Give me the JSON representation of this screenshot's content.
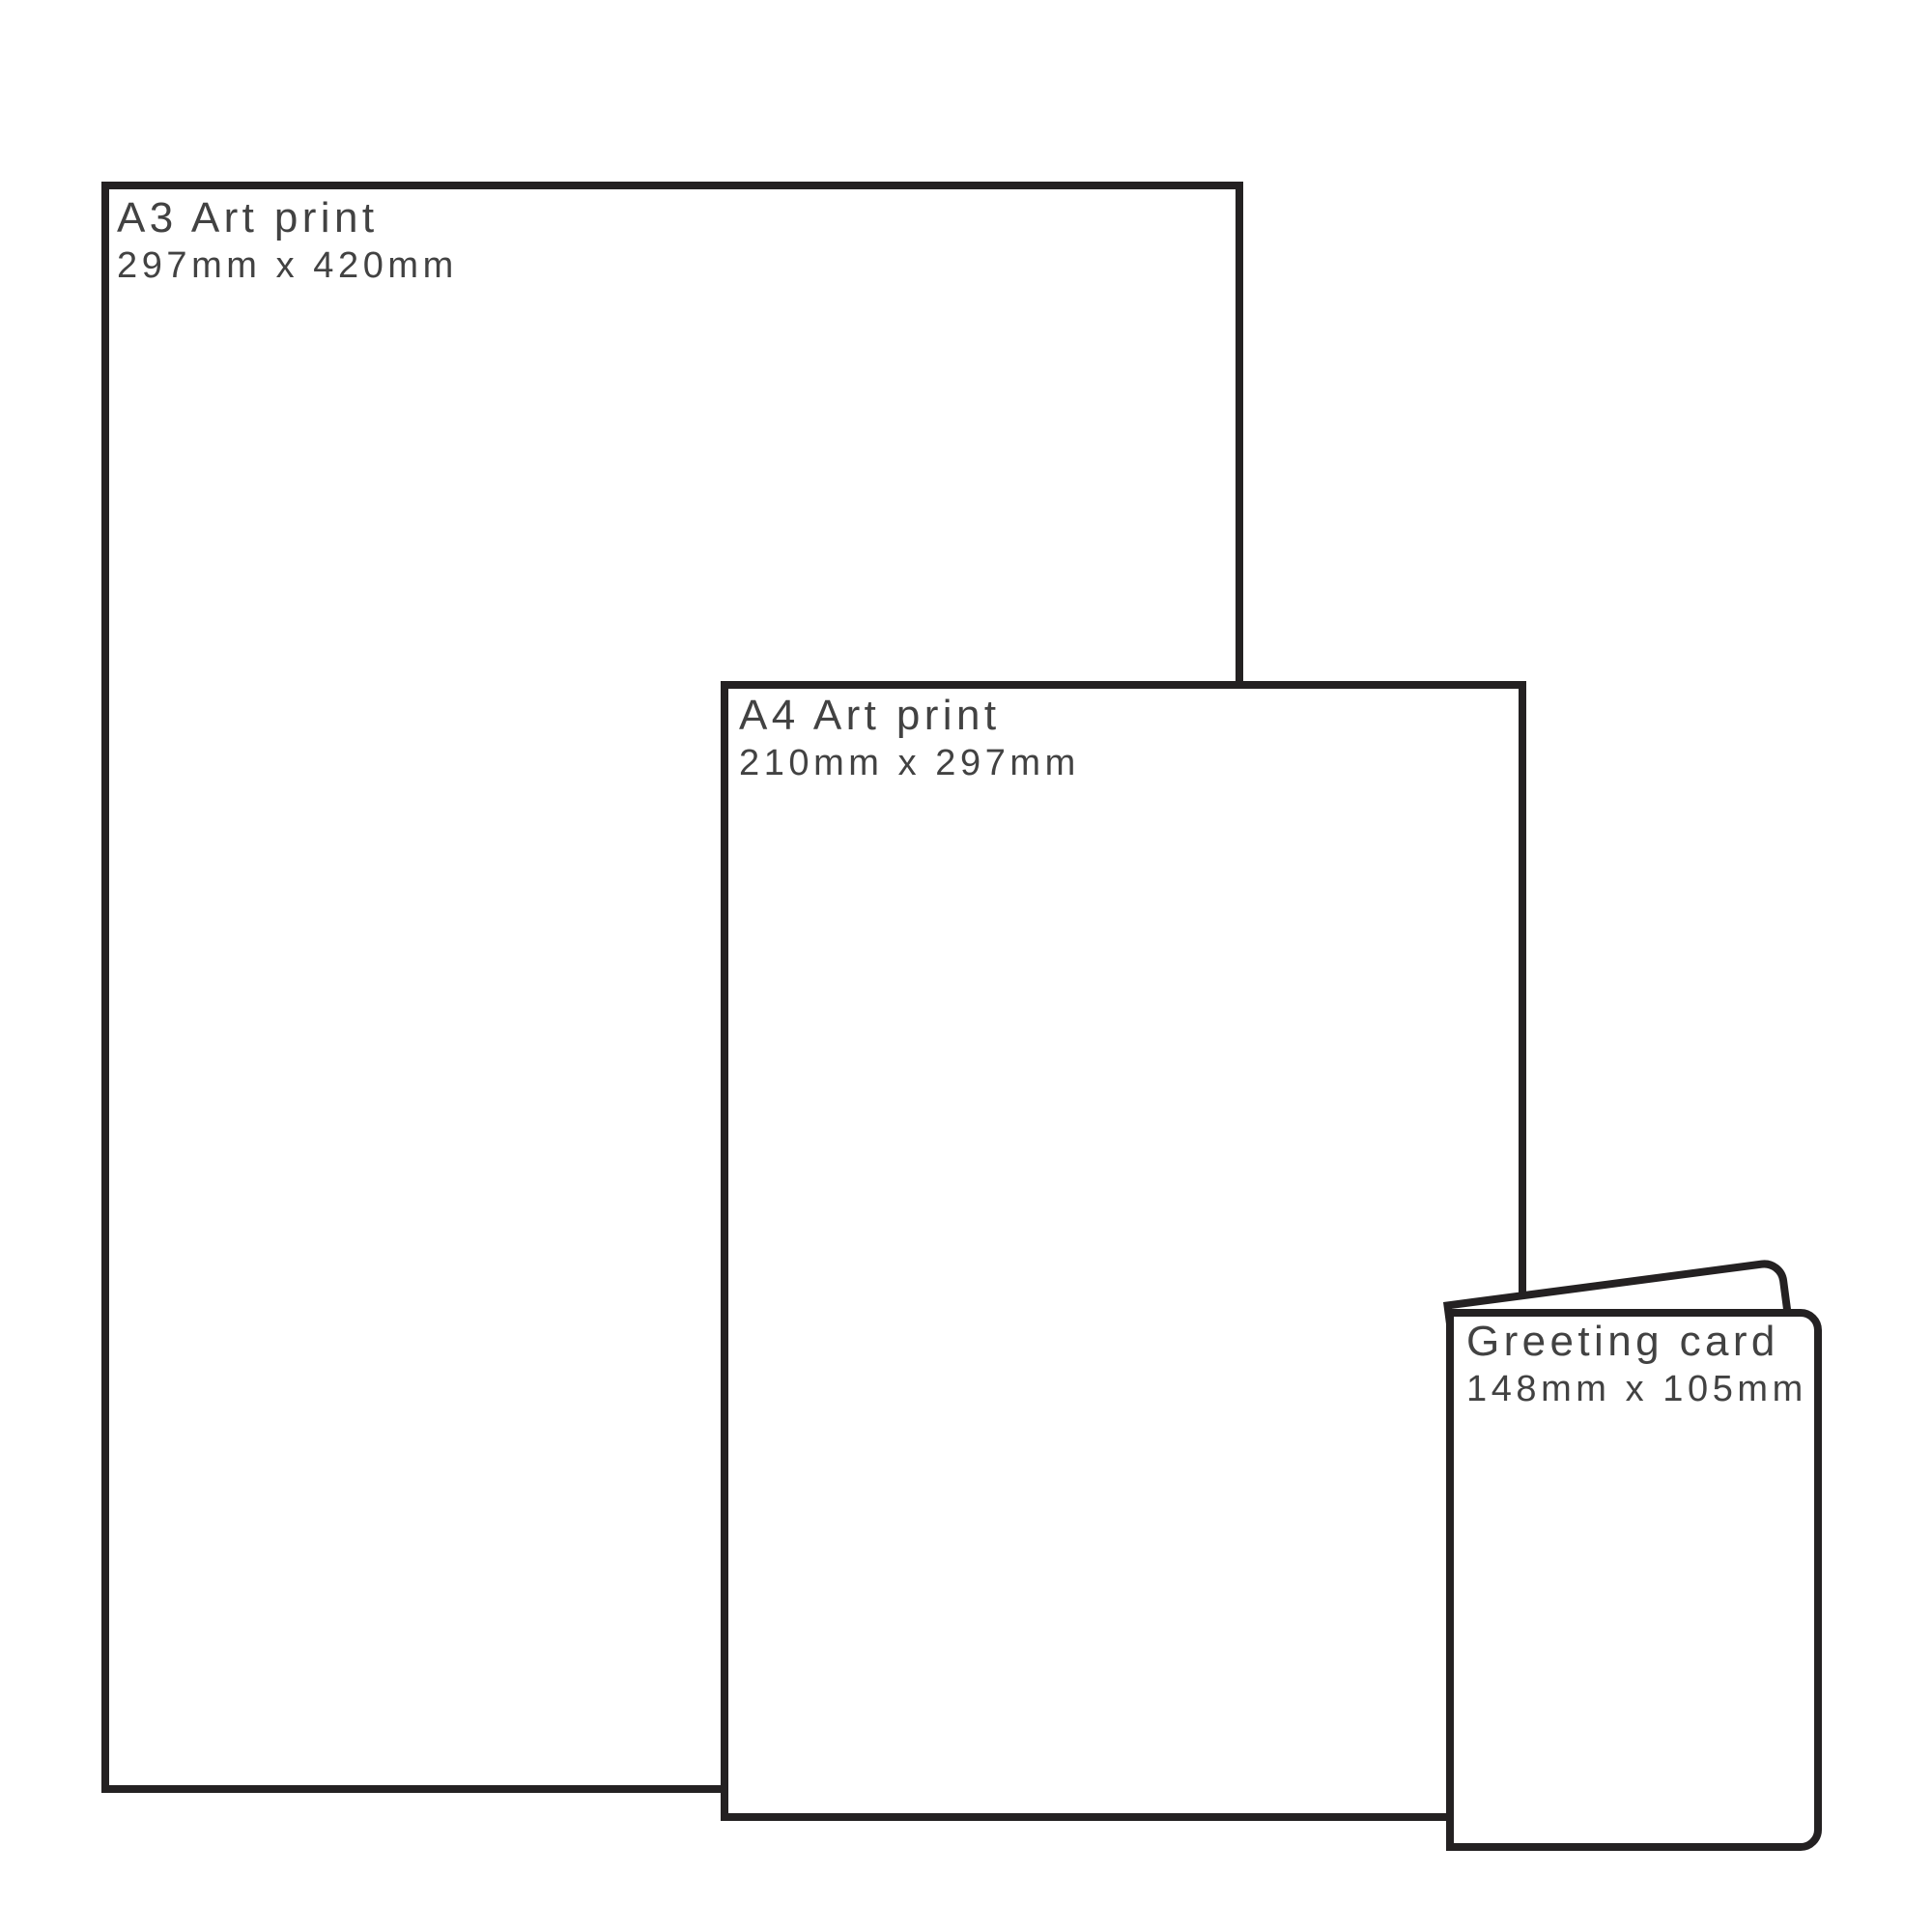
{
  "diagram_title": "Print size comparison",
  "items": [
    {
      "id": "a3-art-print",
      "title": "A3 Art print",
      "dimensions": "297mm x 420mm"
    },
    {
      "id": "a4-art-print",
      "title": "A4 Art print",
      "dimensions": "210mm x 297mm"
    },
    {
      "id": "greeting-card",
      "title": "Greeting card",
      "dimensions": "148mm x 105mm"
    }
  ],
  "colors": {
    "outline": "#242122",
    "label": "#424242",
    "fill": "#ffffff"
  }
}
